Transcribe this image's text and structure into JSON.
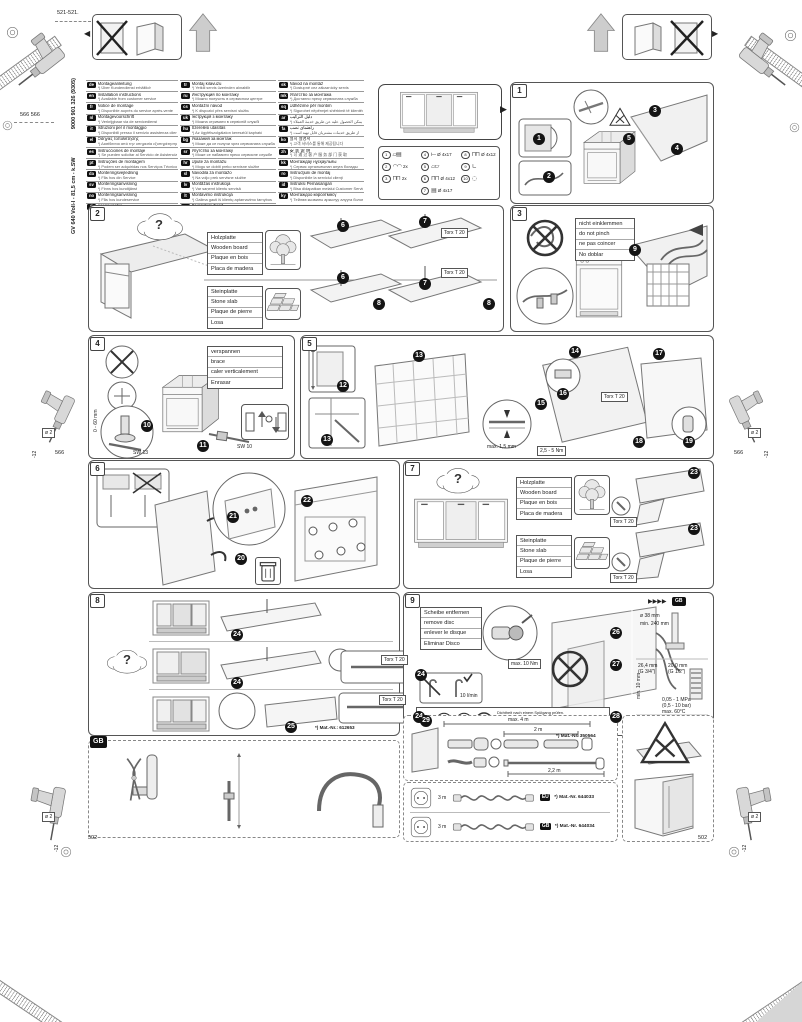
{
  "doc": {
    "model": "GV 640 Voll-I - 81,5 cm - k.SW",
    "number": "9000 901 326 (9305)"
  },
  "edge": {
    "top_left_dim": "521-521.",
    "left_dim_pair": "566 566",
    "mid_dim_left": "566",
    "mid_dim_right": "566",
    "bottom_dim_left": "502",
    "bottom_dim_right": "502",
    "drill_dia": "ø 2",
    "drill_depth": "-12"
  },
  "misc": {
    "q": "?",
    "gb": "GB",
    "arrows": "▶▶▶▶"
  },
  "labels": {
    "torx": "Torx T 20",
    "sw13": "SW 13",
    "sw10": "SW 10",
    "range": "0 - 60 mm",
    "gap": "max. 1,5 mm",
    "torque": "2,5 - 5 Nm"
  },
  "wood": [
    "Holzplatte",
    "Wooden board",
    "Plaque en bois",
    "Placa de madera"
  ],
  "stone": [
    "Steinplatte",
    "Stone slab",
    "Plaque de pierre",
    "Losa"
  ],
  "lang_col1": [
    {
      "code": "de",
      "title": "Montageanleitung",
      "note": "*) Über Kundendienst erhältlich"
    },
    {
      "code": "en",
      "title": "Installation instructions",
      "note": "*) Available from customer service"
    },
    {
      "code": "fr",
      "title": "Notice de montage",
      "note": "*) Disponible auprès du service après-vente"
    },
    {
      "code": "nl",
      "title": "Montagevoorschrift",
      "note": "*) Verkrijgbaar via de servicedienst"
    },
    {
      "code": "it",
      "title": "Istruzioni per il montaggio",
      "note": "*) Disponibili presso il servizio assistenza clienti"
    },
    {
      "code": "el",
      "title": "Οδηγίες τοποθέτησης",
      "note": "*) Διατίθενται από την υπηρεσία εξυπηρέτησης πελατών"
    },
    {
      "code": "es",
      "title": "Instrucciones de montaje",
      "note": "*) Se pueden solicitar al Servicio de Asistencia Técnica"
    },
    {
      "code": "pt",
      "title": "Instruções de montagem",
      "note": "*) Podem ser adquiridas nos Serviços Técnicos"
    },
    {
      "code": "da",
      "title": "Monteringsvejledning",
      "note": "*) Fås hos din Service"
    },
    {
      "code": "sv",
      "title": "Monteringsanvisning",
      "note": "*) Finns hos kundtjänst"
    },
    {
      "code": "no",
      "title": "Monteringsanvisning",
      "note": "*) Fås hos kundeservice"
    },
    {
      "code": "fi",
      "title": "Asennusohje",
      "note": "*) Saatavana huoltopalvelusta"
    }
  ],
  "lang_col2": [
    {
      "code": "tr",
      "title": "Montaj kılavuzu",
      "note": "*) Yetkili servis üzerinden alınabilir"
    },
    {
      "code": "ru",
      "title": "Инструкция по монтажу",
      "note": "*) Можно получить в сервисном центре"
    },
    {
      "code": "cs",
      "title": "Montážní návod",
      "note": "*) K dispozici přes servisní službu"
    },
    {
      "code": "uk",
      "title": "Інструкція з монтажу",
      "note": "*) Можна отримати в сервісній службі"
    },
    {
      "code": "hu",
      "title": "Szerelési utasítás",
      "note": "*) Az ügyfélszolgálaton keresztül kapható"
    },
    {
      "code": "bg",
      "title": "Указания за монтаж",
      "note": "*) Може да се получи чрез сервизната служба"
    },
    {
      "code": "sr",
      "title": "Упутство за монтажу",
      "note": "*) Може се набавити преко сервисне службе"
    },
    {
      "code": "hr",
      "title": "Upute za montažu",
      "note": "*) Mogu se dobiti preko servisne službe"
    },
    {
      "code": "sl",
      "title": "Navodila za montažo",
      "note": "*) Na voljo prek servisne službe"
    },
    {
      "code": "lv",
      "title": "Montāžas instrukcija",
      "note": "*) Var saņemt klientu servisā"
    },
    {
      "code": "lt",
      "title": "Montavimo instrukcija",
      "note": "*) Galima gauti iš klientų aptarnavimo tarnybos"
    },
    {
      "code": "et",
      "title": "Paigaldusjuhend",
      "note": "*) Saadaval klienditeeninduse kaudu"
    }
  ],
  "lang_col3": [
    {
      "code": "sk",
      "title": "Návod na montáž",
      "note": "*) Dostupné cez zákaznícky servis"
    },
    {
      "code": "mk",
      "title": "Упатство за монтажа",
      "note": "*) Достапно преку сервисната служба"
    },
    {
      "code": "sq",
      "title": "Udhëzime për montim",
      "note": "*) Sigurohet nëpërmjet shërbimit të klientëve"
    },
    {
      "code": "ar",
      "title": "دليل التركيب",
      "note": "*) يمكن الحصول عليه عن طريق خدمة العملاء"
    },
    {
      "code": "fa",
      "title": "راهنمای نصب",
      "note": "*) از طریق خدمات مشتریان قابل تهیه است"
    },
    {
      "code": "ko",
      "title": "설치 설명서",
      "note": "*) 고객 서비스를 통해 제공됩니다"
    },
    {
      "code": "zh",
      "title": "安 装 说 明",
      "note": "*) 可 通 过 客 户 服 务 部 门 获 取"
    },
    {
      "code": "kk",
      "title": "Монтаждау нұсқаулығы",
      "note": "*) Сервис орталығынан алуға болады"
    },
    {
      "code": "ro",
      "title": "Instrucţiuni de montaj",
      "note": "*) Disponibile la serviciul clienţi"
    },
    {
      "code": "id",
      "title": "Instruksi Pemasangan",
      "note": "*) Bisa didapatkan melalui Customer Service"
    },
    {
      "code": "ky",
      "title": "Монтаждоо көрсөтмөсү",
      "note": "*) Тейлөө кызматы аркылуу алууга болот"
    }
  ],
  "parts_col1": [
    {
      "n": "1",
      "icon": "▱▤",
      "label": ""
    },
    {
      "n": "2",
      "icon": "◠◠",
      "label": "2x"
    },
    {
      "n": "3",
      "icon": "⊓⊓",
      "label": "2x"
    }
  ],
  "parts_col2": [
    {
      "n": "4",
      "icon": "⟝",
      "label": "Ø 4x17"
    },
    {
      "n": "5",
      "icon": "▱▱",
      "label": ""
    },
    {
      "n": "6",
      "icon": "⊓⊓",
      "label": "Ø 4x12"
    },
    {
      "n": "7",
      "icon": "▤",
      "label": "Ø 4x17"
    }
  ],
  "parts_col3": [
    {
      "n": "8",
      "icon": "⊓⊓",
      "label": "Ø 4x12"
    },
    {
      "n": "9",
      "icon": "∟",
      "label": ""
    },
    {
      "n": "10",
      "icon": "◌",
      "label": ""
    }
  ],
  "panels": {
    "p1": {
      "num": "1",
      "steps": [
        "1",
        "2",
        "3",
        "4",
        "5"
      ]
    },
    "p2": {
      "num": "2",
      "steps": [
        "6",
        "7",
        "8"
      ]
    },
    "p3": {
      "num": "3",
      "warn": [
        "nicht einklemmen",
        "do not pinch",
        "ne pas coincer",
        "No doblar"
      ],
      "steps": [
        "9"
      ]
    },
    "p4": {
      "num": "4",
      "brace": [
        "verspannen",
        "brace",
        "caler verticalement",
        "Enrasar"
      ],
      "steps": [
        "10",
        "11"
      ]
    },
    "p5": {
      "num": "5",
      "steps": [
        "12",
        "13",
        "14",
        "15",
        "16",
        "17",
        "18",
        "19"
      ]
    },
    "p6": {
      "num": "6",
      "steps": [
        "20",
        "21",
        "22"
      ]
    },
    "p7": {
      "num": "7",
      "steps": [
        "23"
      ]
    },
    "p8": {
      "num": "8",
      "matnr": "*) Mat.-Nr.: 612653",
      "steps": [
        "24",
        "25"
      ]
    },
    "p9": {
      "num": "9",
      "title": [
        "Scheibe entfernen",
        "remove disc",
        "enlever le disque",
        "Eliminar Disco"
      ],
      "flow": "10 l/min",
      "max_torque": "max. 10 Nm",
      "drain_dia": "ø 38 mm",
      "drain_min": "min. 240 mm",
      "conn_a": "26,4 mm",
      "conn_a2": "(G 3/4\")",
      "conn_b": "20,0 mm",
      "conn_b2": "(G 1/2\")",
      "min_gap": "min. 10 mm",
      "pressure": "0,05 - 1 MPa",
      "pressure_bar": "(0,5 - 10 bar)",
      "temp": "max. 60°C",
      "check": [
        "Dichtheit nach einem Spülgang prüfen.",
        "Check for leaks after one wash cycle.",
        "Vérifier l'étanchéité après un lavage.",
        "Verificar la estanqueidad tras un ciclo de lavado."
      ],
      "steps": [
        "26",
        "27",
        "28",
        "29"
      ]
    }
  },
  "bottom": {
    "gb_badge": "GB",
    "hose": {
      "max": "max. 4 m",
      "l2": "2 m",
      "l22": "2,2 m",
      "matnr": "*) Mat.-Nr. 350564"
    },
    "power_rows": [
      {
        "len": "3 m",
        "badge": "EU",
        "matnr": "*) Mat.-Nr. 644033"
      },
      {
        "len": "3 m",
        "badge": "GB",
        "matnr": "*) Mat.-Nr. 644034"
      }
    ]
  }
}
